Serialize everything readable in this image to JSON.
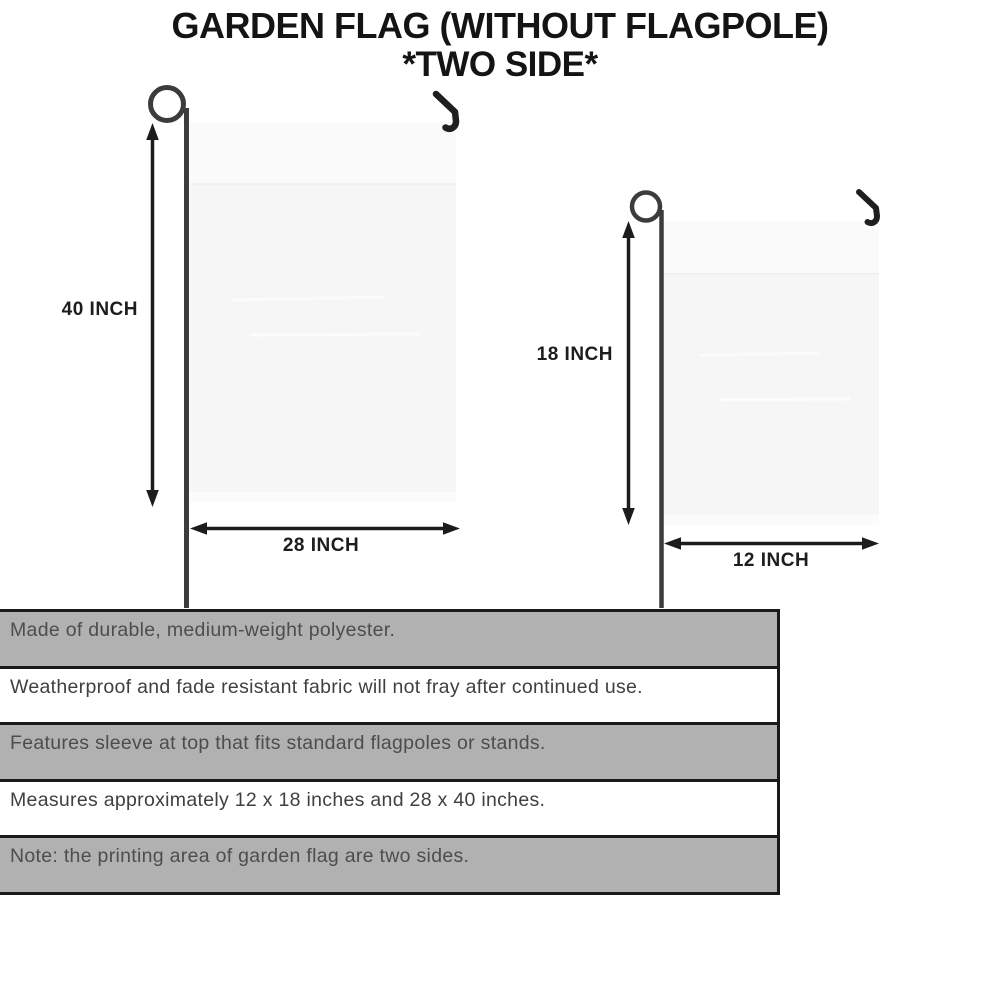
{
  "title": {
    "line1": "GARDEN FLAG (WITHOUT FLAGPOLE)",
    "line2": "*TWO SIDE*"
  },
  "diagrams": {
    "large_flag": {
      "height_label": "40 INCH",
      "width_label": "28 INCH"
    },
    "small_flag": {
      "height_label": "18 INCH",
      "width_label": "12 INCH"
    }
  },
  "features": [
    {
      "text": "Made of durable, medium-weight polyester."
    },
    {
      "text": "Weatherproof and fade resistant fabric will not fray after continued use."
    },
    {
      "text": "Features sleeve at top that fits standard flagpoles or stands."
    },
    {
      "text": "Measures approximately 12 x 18 inches and 28 x 40 inches."
    },
    {
      "text": "Note: the printing area of garden flag are two sides."
    }
  ],
  "icons": {
    "flagpole": "flagpole-with-loop-icon",
    "hook": "pole-hook-icon",
    "dimension_arrow": "double-headed-arrow-icon"
  },
  "colors": {
    "shaded_row_bg": "#b2b1b2",
    "flag_fabric": "#f6f6f6",
    "pole": "#3c3c3c",
    "arrow": "#1c1c1c",
    "title_text": "#141414",
    "shaded_row_text": "#4e4c4d",
    "plain_row_text": "#404040"
  }
}
